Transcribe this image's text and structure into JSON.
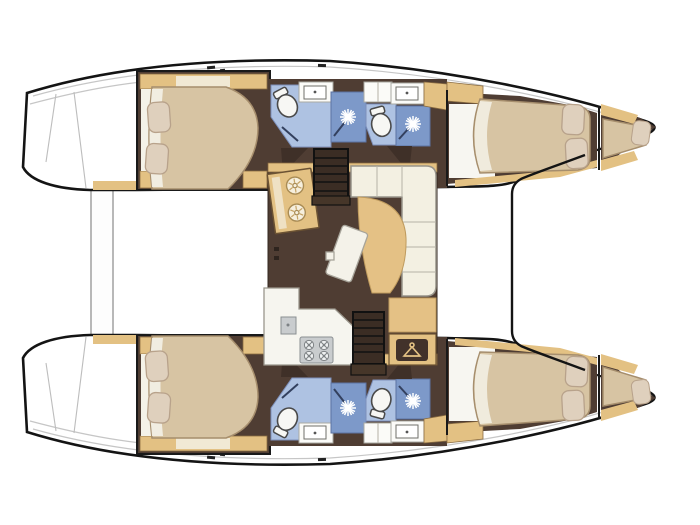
{
  "colors": {
    "background": "#ffffff",
    "hull_outline": "#141414",
    "hull_fill": "#ffffff",
    "deck_line": "#c6c6c6",
    "floor_brown": "#4f3d33",
    "floor_dark": "#3b2d24",
    "wood_tan": "#e3c183",
    "wood_edge": "#8a6c42",
    "bed_beige": "#d7c4a3",
    "bed_edge": "#a68e6d",
    "sheet_white": "#f4f2e8",
    "pillow": "#dfd0bd",
    "pillow_edge": "#b8a28b",
    "sofa_cream": "#f3f0e2",
    "sofa_edge": "#98948a",
    "table_white": "#f4f2e9",
    "bath_blue": "#aec2e2",
    "shower_blue": "#7d99c9",
    "shower_edge": "#5c73a3",
    "appliance_gray": "#c9ccce",
    "appliance_edge": "#8b8f92",
    "accent_dark": "#2e241e"
  },
  "diagram": {
    "type": "boat-floorplan",
    "vessel": "sailing-catamaran",
    "view": "overhead interior layout, bows pointing right",
    "hull_count": 2,
    "cabin_count": 4,
    "bathroom_count": 4,
    "port_hull_top": {
      "aft_cabin": [
        "island-double-bed",
        "2-pillows",
        "wood-trim"
      ],
      "aft_bathroom": [
        "toilet",
        "washbasin",
        "shower-with-sun-symbol"
      ],
      "forward_bathroom": [
        "toilet",
        "washbasin",
        "shower-with-sun-symbol"
      ],
      "forward_cabin": [
        "double-bed",
        "2-pillows"
      ],
      "bow_peak": [
        "single-berth",
        "pillow"
      ]
    },
    "starboard_hull_bottom": "mirror image of port hull",
    "saloon": {
      "items": [
        "twin-basin-galley-unit",
        "companionway-stairs-to-port-hull",
        "l-shaped-sofa",
        "chaise-cushion",
        "tilted-cocktail-table",
        "galley-counter",
        "4-burner-stove",
        "galley-sink",
        "companionway-stairs-to-starboard-hull",
        "wardrobe-with-hanger-icon"
      ]
    },
    "exterior": [
      "stern-crossbeam-platform",
      "transom-steps",
      "foredeck-trampoline-frame",
      "deck-cleats"
    ]
  },
  "icons": {
    "shower": "sun-starburst-icon",
    "toilet": "toilet-bowl-icon",
    "basin": "round-basin-icon",
    "stove": "burner-grid-icon",
    "wardrobe": "clothes-hanger-icon",
    "stairs": "tread-steps-icon",
    "door": "door-swing-wedge"
  }
}
